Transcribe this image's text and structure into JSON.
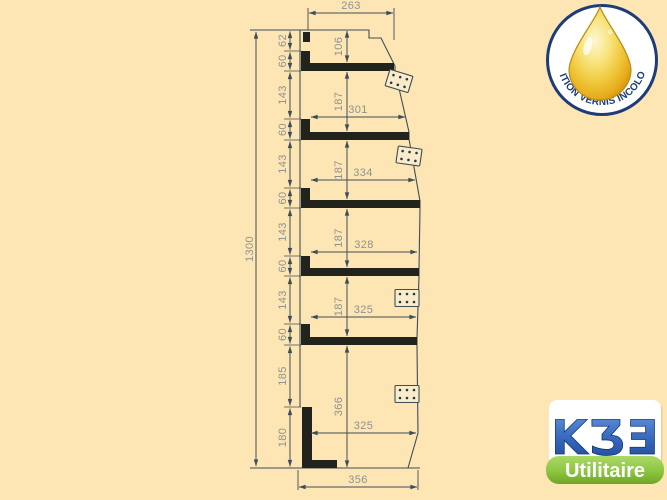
{
  "colors": {
    "background": "#FDE5B4",
    "line": "#3e4e58",
    "profile_bar": "#23231d",
    "dimension_text": "#8f938e",
    "badge_navy": "#1e3c7a",
    "drop_gold": "#f0c93e",
    "logo_blue": "#1c4494",
    "logo_green": "#8cc63f"
  },
  "drawing": {
    "overall_height": "1300",
    "top_width": "263",
    "bottom_width": "356",
    "chain_segments": [
      "62",
      "60",
      "143",
      "60",
      "143",
      "60",
      "143",
      "60",
      "143",
      "60",
      "185",
      "180"
    ],
    "shelf_lengths": [
      "301",
      "334",
      "328",
      "325",
      "325"
    ],
    "vertical_gaps": [
      "106",
      "187",
      "187",
      "187",
      "187",
      "366"
    ]
  },
  "badge": {
    "label": "FINITION VERNIS INCOLORE"
  },
  "logo": {
    "brand": "KƷƎ",
    "tagline": "Utilitaire"
  }
}
